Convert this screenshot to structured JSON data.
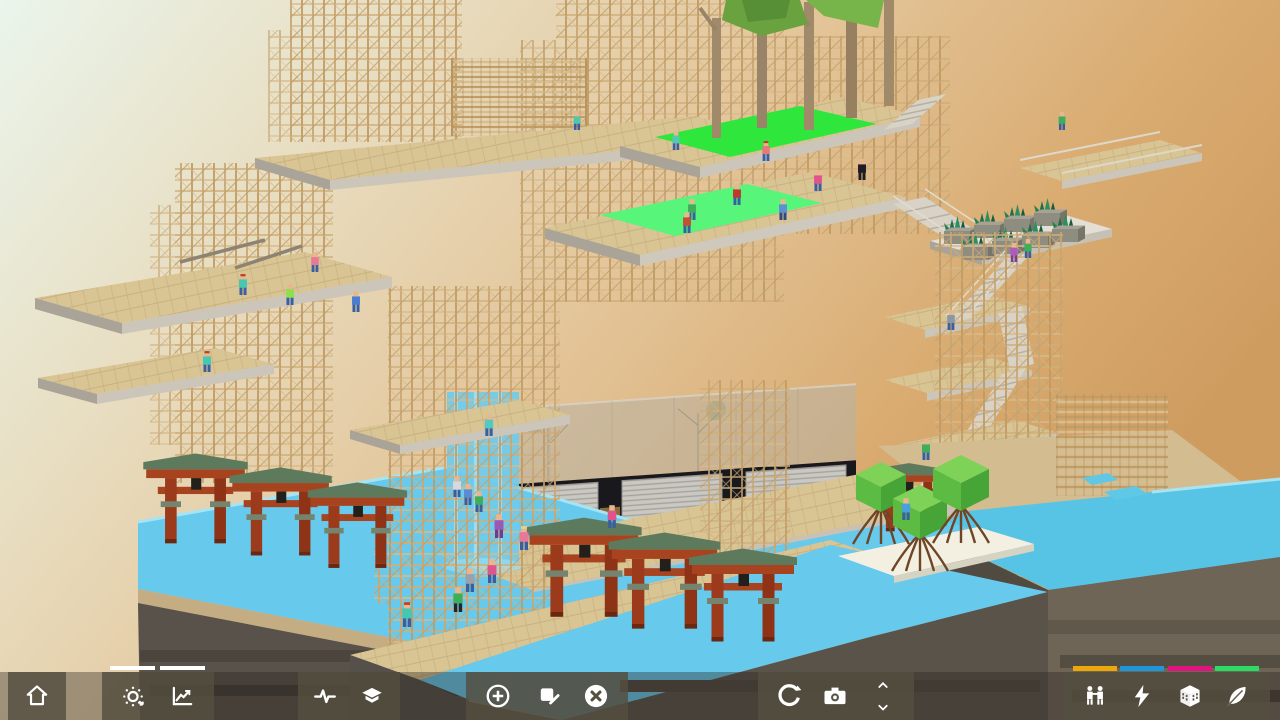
{
  "toolbar": {
    "tab_indicator_color": "#FFFFFF",
    "buttons": [
      {
        "name": "home",
        "icon": "home-icon"
      },
      {
        "name": "environment-cycle",
        "icon": "sun-cycle-icon",
        "active_tab": true
      },
      {
        "name": "statistics",
        "icon": "line-chart-icon",
        "active_tab": true
      },
      {
        "name": "pulse",
        "icon": "pulse-icon"
      },
      {
        "name": "layers",
        "icon": "layers-icon"
      },
      {
        "name": "add-block",
        "icon": "plus-circle-icon"
      },
      {
        "name": "annotate",
        "icon": "marker-icon"
      },
      {
        "name": "delete-block",
        "icon": "x-circle-icon"
      },
      {
        "name": "rotate-view",
        "icon": "rotate-icon"
      },
      {
        "name": "screenshot",
        "icon": "camera-icon"
      },
      {
        "name": "level-up",
        "icon": "chevron-up-icon"
      },
      {
        "name": "level-down",
        "icon": "chevron-down-icon"
      },
      {
        "name": "population",
        "icon": "people-icon"
      },
      {
        "name": "energy",
        "icon": "lightning-icon"
      },
      {
        "name": "buildings",
        "icon": "building-icon"
      },
      {
        "name": "ecology",
        "icon": "leaf-icon"
      }
    ],
    "resource_meters": [
      {
        "name": "population",
        "color": "#ECA70A"
      },
      {
        "name": "energy",
        "color": "#1E96DC"
      },
      {
        "name": "buildings",
        "color": "#E2127E"
      },
      {
        "name": "ecology",
        "color": "#2BDB66"
      }
    ]
  },
  "scene": {
    "background": {
      "top_left": "#EAF5EC",
      "middle": "#E8D8B4",
      "right": "#D29E64"
    },
    "water_color": "#67C9EC",
    "grass_colors": [
      "#2FE73C",
      "#58F57B"
    ],
    "wood_color": "#CDAC79",
    "landmarks": [
      "wood-lattice-towers",
      "cantilever-platforms",
      "grass-terraces-with-trees",
      "planter-terrace",
      "zigzag-stairs",
      "storefront-with-shutters",
      "torii-gates",
      "waterfall",
      "mangrove-trees",
      "water-moat",
      "cliff-plinth"
    ],
    "torii_gates": [
      {
        "x": 152,
        "y": 452,
        "s": 1.45
      },
      {
        "x": 238,
        "y": 466,
        "s": 1.42
      },
      {
        "x": 316,
        "y": 481,
        "s": 1.38
      },
      {
        "x": 536,
        "y": 516,
        "s": 1.6
      },
      {
        "x": 618,
        "y": 531,
        "s": 1.55
      },
      {
        "x": 698,
        "y": 547,
        "s": 1.5
      },
      {
        "x": 876,
        "y": 462,
        "s": 1.1
      }
    ],
    "planters": [
      {
        "x": 944,
        "y": 226
      },
      {
        "x": 974,
        "y": 220
      },
      {
        "x": 1004,
        "y": 214
      },
      {
        "x": 1034,
        "y": 208
      },
      {
        "x": 962,
        "y": 242
      },
      {
        "x": 992,
        "y": 236
      },
      {
        "x": 1022,
        "y": 230
      },
      {
        "x": 1052,
        "y": 224
      }
    ],
    "mangroves": [
      {
        "x": 856,
        "y": 462,
        "s": 50
      },
      {
        "x": 893,
        "y": 485,
        "s": 54
      },
      {
        "x": 933,
        "y": 455,
        "s": 56
      }
    ],
    "people": [
      {
        "x": 577,
        "y": 130,
        "sc": 0.95,
        "s": "#4fc7a9"
      },
      {
        "x": 676,
        "y": 150,
        "sc": 1.0,
        "s": "#56c8b2"
      },
      {
        "x": 766,
        "y": 161,
        "sc": 1.05,
        "s": "#e8797b",
        "h": "#c23b24"
      },
      {
        "x": 862,
        "y": 180,
        "sc": 1.1,
        "s": "#1d1c22",
        "p": "#1d1c22"
      },
      {
        "x": 818,
        "y": 191,
        "sc": 1.1,
        "s": "#e0548c"
      },
      {
        "x": 737,
        "y": 205,
        "sc": 1.1,
        "s": "#bf3a2e"
      },
      {
        "x": 783,
        "y": 220,
        "sc": 1.1,
        "s": "#5e8fd2",
        "p": "#31497f"
      },
      {
        "x": 692,
        "y": 220,
        "sc": 1.1,
        "s": "#3fae5a"
      },
      {
        "x": 687,
        "y": 233,
        "sc": 1.1,
        "s": "#c4502f"
      },
      {
        "x": 1062,
        "y": 130,
        "sc": 0.95,
        "s": "#3fae5a"
      },
      {
        "x": 243,
        "y": 295,
        "sc": 1.1,
        "s": "#45c8b0",
        "h": "#c23b24"
      },
      {
        "x": 290,
        "y": 305,
        "sc": 1.1,
        "s": "#8ee04a"
      },
      {
        "x": 315,
        "y": 272,
        "sc": 1.05,
        "s": "#e87898"
      },
      {
        "x": 356,
        "y": 312,
        "sc": 1.1,
        "s": "#4a7fd0"
      },
      {
        "x": 207,
        "y": 372,
        "sc": 1.1,
        "s": "#45c8b0",
        "h": "#c23b24"
      },
      {
        "x": 489,
        "y": 436,
        "sc": 1.15,
        "s": "#52c8c0"
      },
      {
        "x": 1014,
        "y": 262,
        "sc": 1.0,
        "s": "#b05ac0",
        "p": "#7a3f93"
      },
      {
        "x": 1028,
        "y": 258,
        "sc": 1.0,
        "s": "#3fae5a"
      },
      {
        "x": 951,
        "y": 330,
        "sc": 1.05,
        "s": "#8a97a5"
      },
      {
        "x": 926,
        "y": 460,
        "sc": 1.1,
        "s": "#3fae5a"
      },
      {
        "x": 906,
        "y": 520,
        "sc": 1.15,
        "s": "#4aa0d8"
      },
      {
        "x": 457,
        "y": 497,
        "sc": 1.1,
        "s": "#d8d8de"
      },
      {
        "x": 468,
        "y": 505,
        "sc": 1.1,
        "s": "#5b8bd0"
      },
      {
        "x": 479,
        "y": 512,
        "sc": 1.1,
        "s": "#3fae5a"
      },
      {
        "x": 499,
        "y": 538,
        "sc": 1.25,
        "s": "#9b59b6",
        "p": "#6d3d8f"
      },
      {
        "x": 612,
        "y": 528,
        "sc": 1.2,
        "s": "#e0548c"
      },
      {
        "x": 524,
        "y": 550,
        "sc": 1.25,
        "s": "#e87898",
        "h": "#e8d48a"
      },
      {
        "x": 407,
        "y": 627,
        "sc": 1.3,
        "s": "#45c8b0",
        "h": "#c23b24"
      },
      {
        "x": 458,
        "y": 612,
        "sc": 1.3,
        "s": "#3fae5a",
        "p": "#23252b"
      },
      {
        "x": 470,
        "y": 592,
        "sc": 1.25,
        "s": "#9aa1ab"
      },
      {
        "x": 492,
        "y": 583,
        "sc": 1.25,
        "s": "#e0548c"
      }
    ]
  }
}
